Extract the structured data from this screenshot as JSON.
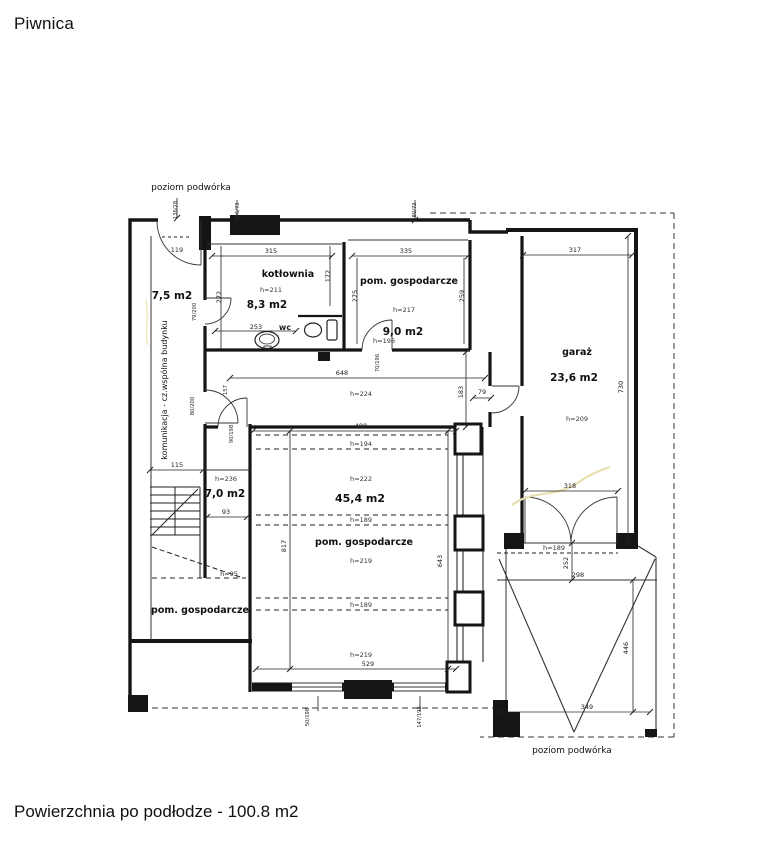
{
  "title": "Piwnica",
  "footer": "Powierzchnia po podłodze - 100.8 m2",
  "labels": {
    "yard_top": "poziom podwórka",
    "yard_bottom": "poziom podwórka"
  },
  "rooms": {
    "komunikacja": {
      "label": "komunikacja - cz.wspólna budynku",
      "area": "7,5 m2"
    },
    "kotlownia": {
      "name": "kotłownia",
      "height": "h=211",
      "area": "8,3 m2"
    },
    "wc": {
      "name": "wc"
    },
    "gospodarcze9": {
      "name": "pom. gospodarcze",
      "height": "h=217",
      "area": "9,0 m2"
    },
    "garaz": {
      "name": "garaż",
      "area": "23,6 m2",
      "height": "h=209"
    },
    "gospodarcze45": {
      "name": "pom. gospodarcze",
      "area": "45,4 m2",
      "h_corridor": "h=224",
      "h_a": "h=194",
      "h_b": "h=222",
      "h_c": "h=189",
      "h_d": "h=219",
      "h_e": "h=189",
      "h_f": "h=219"
    },
    "pokoj70": {
      "height": "h=236",
      "area": "7,0 m2"
    },
    "gospodarczeBL": {
      "height": "h=95",
      "name": "pom. gospodarcze"
    }
  },
  "dims": {
    "d119": "119",
    "w_entry": "136/28",
    "w_top1": "96/73",
    "w_top2": "80/73",
    "d315": "315",
    "d172": "172",
    "d272": "272",
    "d253": "253",
    "door_kotlownia": "79/200",
    "door_korytarz": "80/200",
    "d157": "157",
    "door_piwnica": "90/198",
    "d335": "335",
    "d275": "275",
    "d259": "259",
    "door9_h": "h=196",
    "door9_size": "70/196",
    "d648": "648",
    "d488": "488",
    "d79": "79",
    "d183": "183",
    "d317": "317",
    "d730": "730",
    "d318": "318",
    "gdoor_h": "h=189",
    "d252": "252",
    "d298": "298",
    "d446": "446",
    "d349": "349",
    "d115": "115",
    "d93": "93",
    "d529": "529",
    "d817": "817",
    "d643": "643",
    "w_okno1": "50/198",
    "w_okno2": "147/198"
  }
}
